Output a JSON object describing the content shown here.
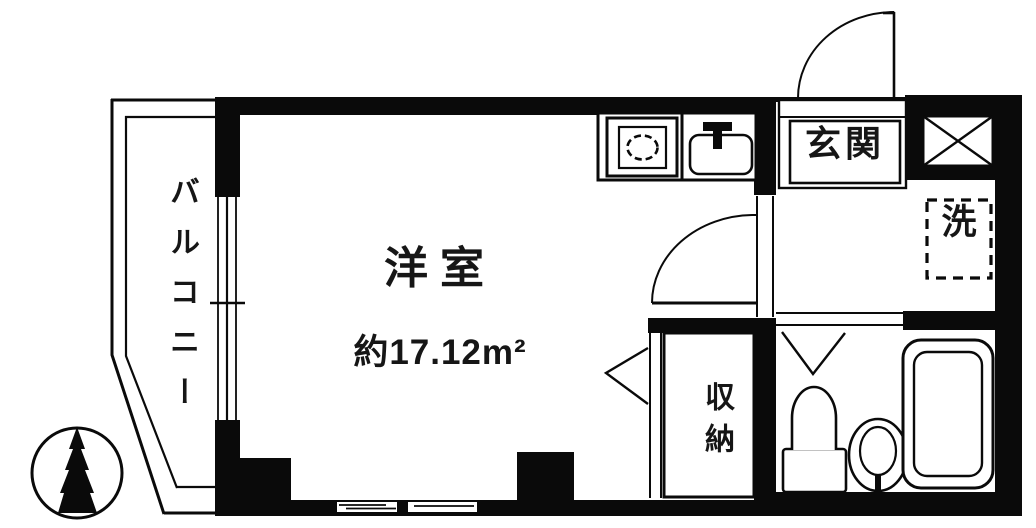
{
  "floorplan": {
    "background": "#ffffff",
    "line_color": "#0a0a0a",
    "rooms": {
      "balcony": "バルコニー",
      "western_room": "洋室",
      "western_room_area": "約17.12m²",
      "entrance": "玄関",
      "laundry": "洗",
      "closet": "収納"
    }
  }
}
